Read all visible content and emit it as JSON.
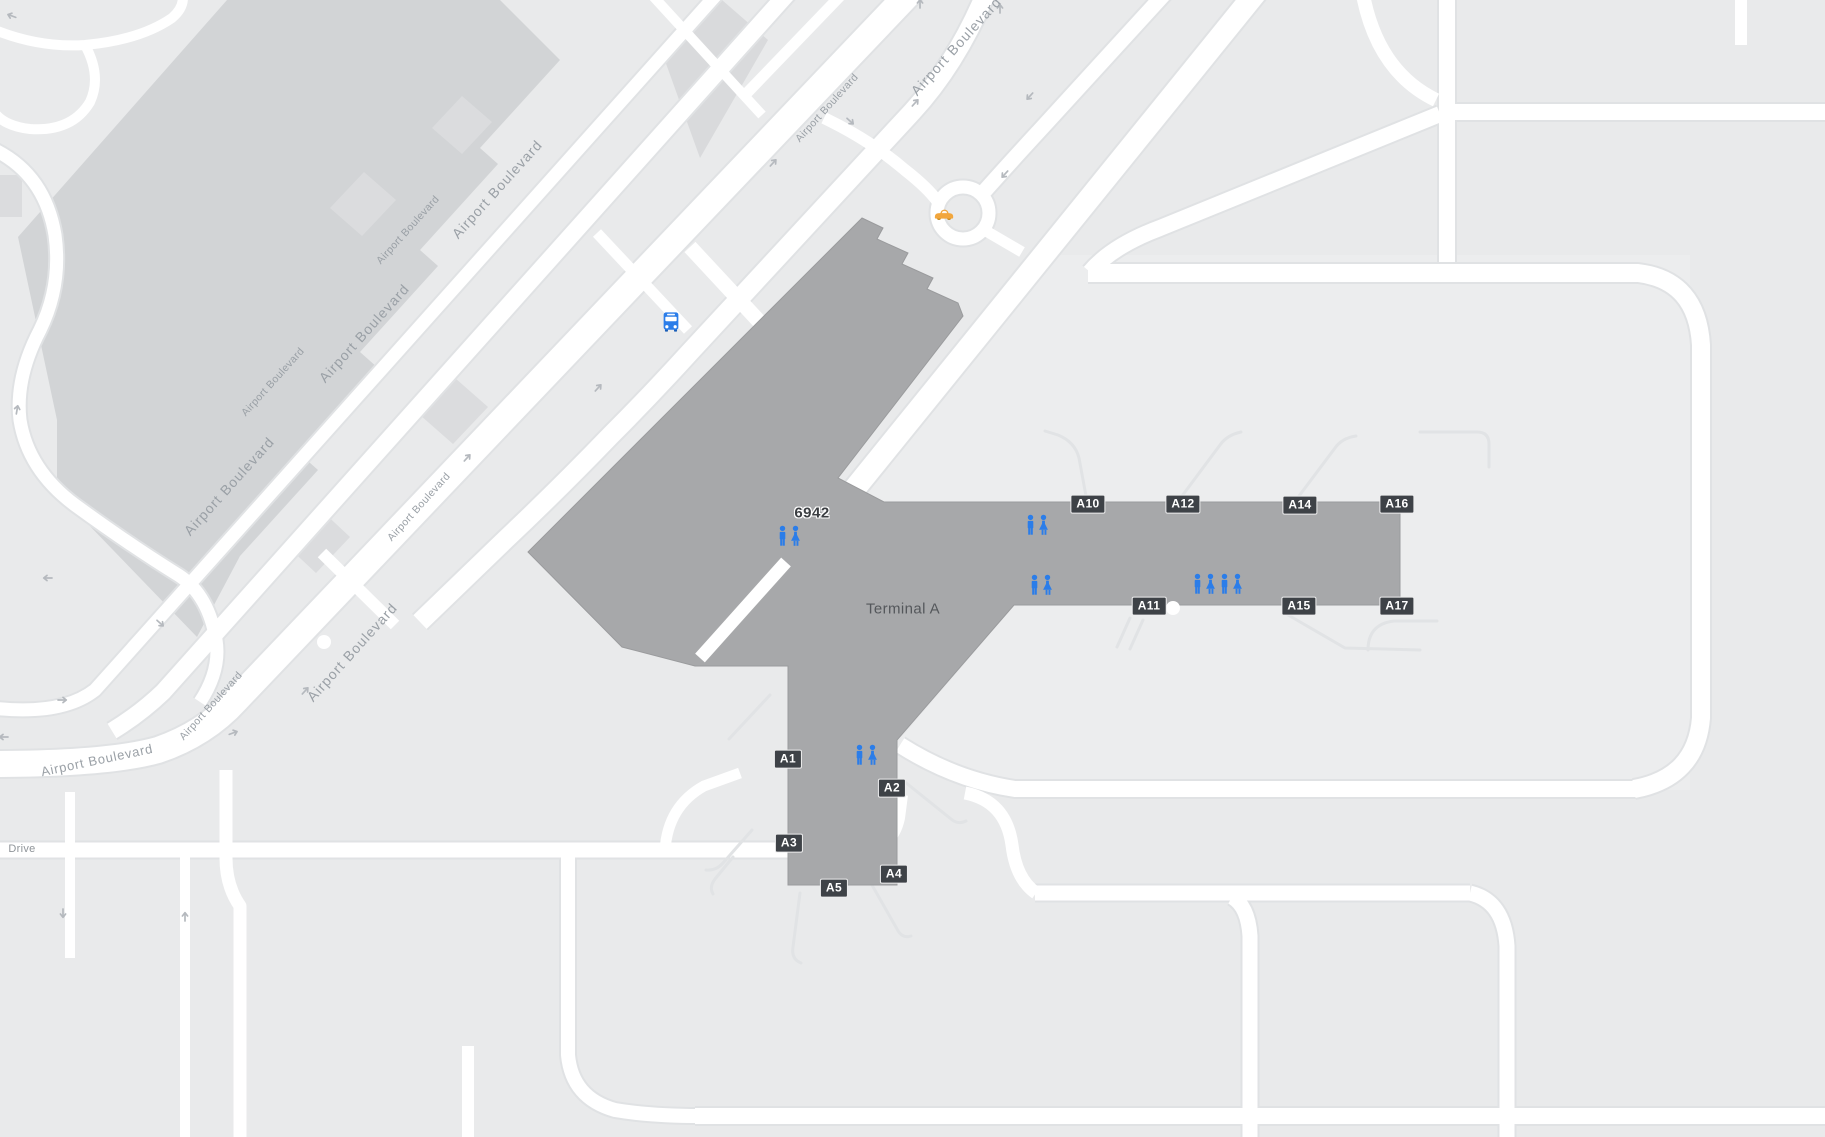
{
  "map": {
    "type": "airport-terminal-map",
    "labels": {
      "terminal": {
        "text": "Terminal A",
        "x": 903,
        "y": 609
      },
      "building_number": {
        "text": "6942",
        "x": 812,
        "y": 513
      }
    },
    "gates": [
      {
        "label": "A1",
        "x": 788,
        "y": 759
      },
      {
        "label": "A2",
        "x": 892,
        "y": 788
      },
      {
        "label": "A3",
        "x": 789,
        "y": 843
      },
      {
        "label": "A4",
        "x": 894,
        "y": 874
      },
      {
        "label": "A5",
        "x": 834,
        "y": 888
      },
      {
        "label": "A10",
        "x": 1088,
        "y": 504
      },
      {
        "label": "A11",
        "x": 1149,
        "y": 606
      },
      {
        "label": "A12",
        "x": 1183,
        "y": 504
      },
      {
        "label": "A14",
        "x": 1300,
        "y": 505
      },
      {
        "label": "A15",
        "x": 1299,
        "y": 606
      },
      {
        "label": "A16",
        "x": 1397,
        "y": 504
      },
      {
        "label": "A17",
        "x": 1397,
        "y": 606
      }
    ],
    "road_labels": [
      {
        "text": "Airport Boulevard",
        "x": 956,
        "y": 46,
        "rot": -48,
        "size": "lg"
      },
      {
        "text": "Airport Boulevard",
        "x": 827,
        "y": 108,
        "rot": -48,
        "size": "sm"
      },
      {
        "text": "Airport Boulevard",
        "x": 497,
        "y": 189,
        "rot": -48,
        "size": "lg"
      },
      {
        "text": "Airport Boulevard",
        "x": 408,
        "y": 230,
        "rot": -48,
        "size": "sm"
      },
      {
        "text": "Airport Boulevard",
        "x": 364,
        "y": 333,
        "rot": -48,
        "size": "lg"
      },
      {
        "text": "Airport Boulevard",
        "x": 273,
        "y": 382,
        "rot": -48,
        "size": "sm"
      },
      {
        "text": "Airport Boulevard",
        "x": 419,
        "y": 507,
        "rot": -48,
        "size": "sm"
      },
      {
        "text": "Airport Boulevard",
        "x": 229,
        "y": 486,
        "rot": -48,
        "size": "lg"
      },
      {
        "text": "Airport Boulevard",
        "x": 352,
        "y": 652,
        "rot": -48,
        "size": "lg"
      },
      {
        "text": "Airport Boulevard",
        "x": 211,
        "y": 706,
        "rot": -48,
        "size": "sm"
      },
      {
        "text": "Airport Boulevard",
        "x": 97,
        "y": 760,
        "rot": -12,
        "size": "md"
      },
      {
        "text": "Drive",
        "x": 22,
        "y": 849,
        "rot": 0,
        "size": "md2"
      }
    ],
    "amenities": {
      "restrooms": [
        {
          "x": 790,
          "y": 536
        },
        {
          "x": 1038,
          "y": 525
        },
        {
          "x": 1042,
          "y": 585
        },
        {
          "x": 1205,
          "y": 584
        },
        {
          "x": 1232,
          "y": 584
        },
        {
          "x": 867,
          "y": 755
        }
      ],
      "bus_stop": {
        "x": 671,
        "y": 322
      },
      "taxi_stand": {
        "x": 944,
        "y": 214
      }
    },
    "colors": {
      "background": "#e9eaeb",
      "apron": "#ecedee",
      "road": "#ffffff",
      "road_casing": "#e0e2e4",
      "terminal_building": "#a7a8aa",
      "parking_structure": "#d2d4d6",
      "parking_substructure": "#dbdcde",
      "gate_badge_bg": "#3e4247",
      "gate_badge_text": "#ffffff",
      "restroom_blue": "#2b7de9",
      "taxi_yellow": "#f2a63c",
      "road_label_gray": "#9aa0a6"
    }
  }
}
